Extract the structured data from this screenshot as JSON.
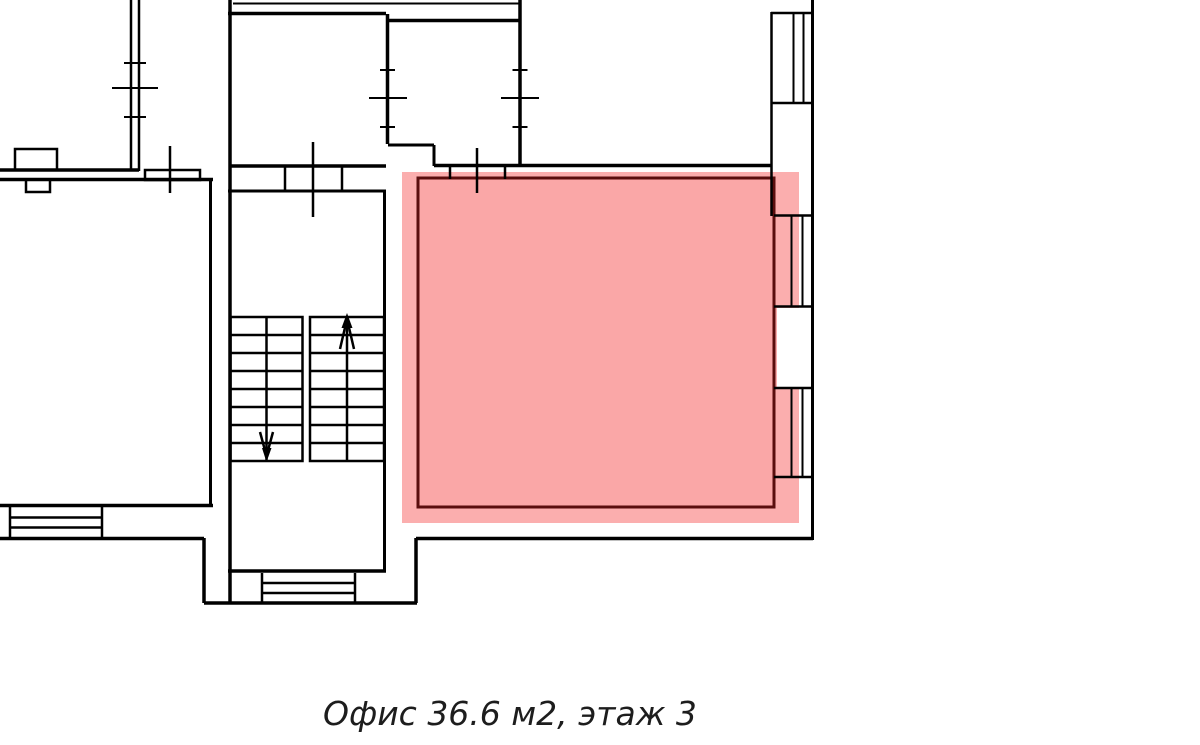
{
  "page": {
    "background": "#ffffff"
  },
  "caption": {
    "text": "Офис 36.6 м2, этаж 3",
    "color": "#1d1d1d"
  },
  "plan": {
    "line_color": "#000000",
    "highlight": {
      "name": "office",
      "halo_color": "#FBAEAE",
      "fill_color": "#FAA7A7",
      "border_color": "#5A0E0E"
    },
    "stairs": {
      "flights": 2,
      "arrows": [
        "down",
        "up"
      ]
    },
    "windows": {
      "right_wall_bays": 3,
      "interior_wall_marks": 3
    }
  }
}
